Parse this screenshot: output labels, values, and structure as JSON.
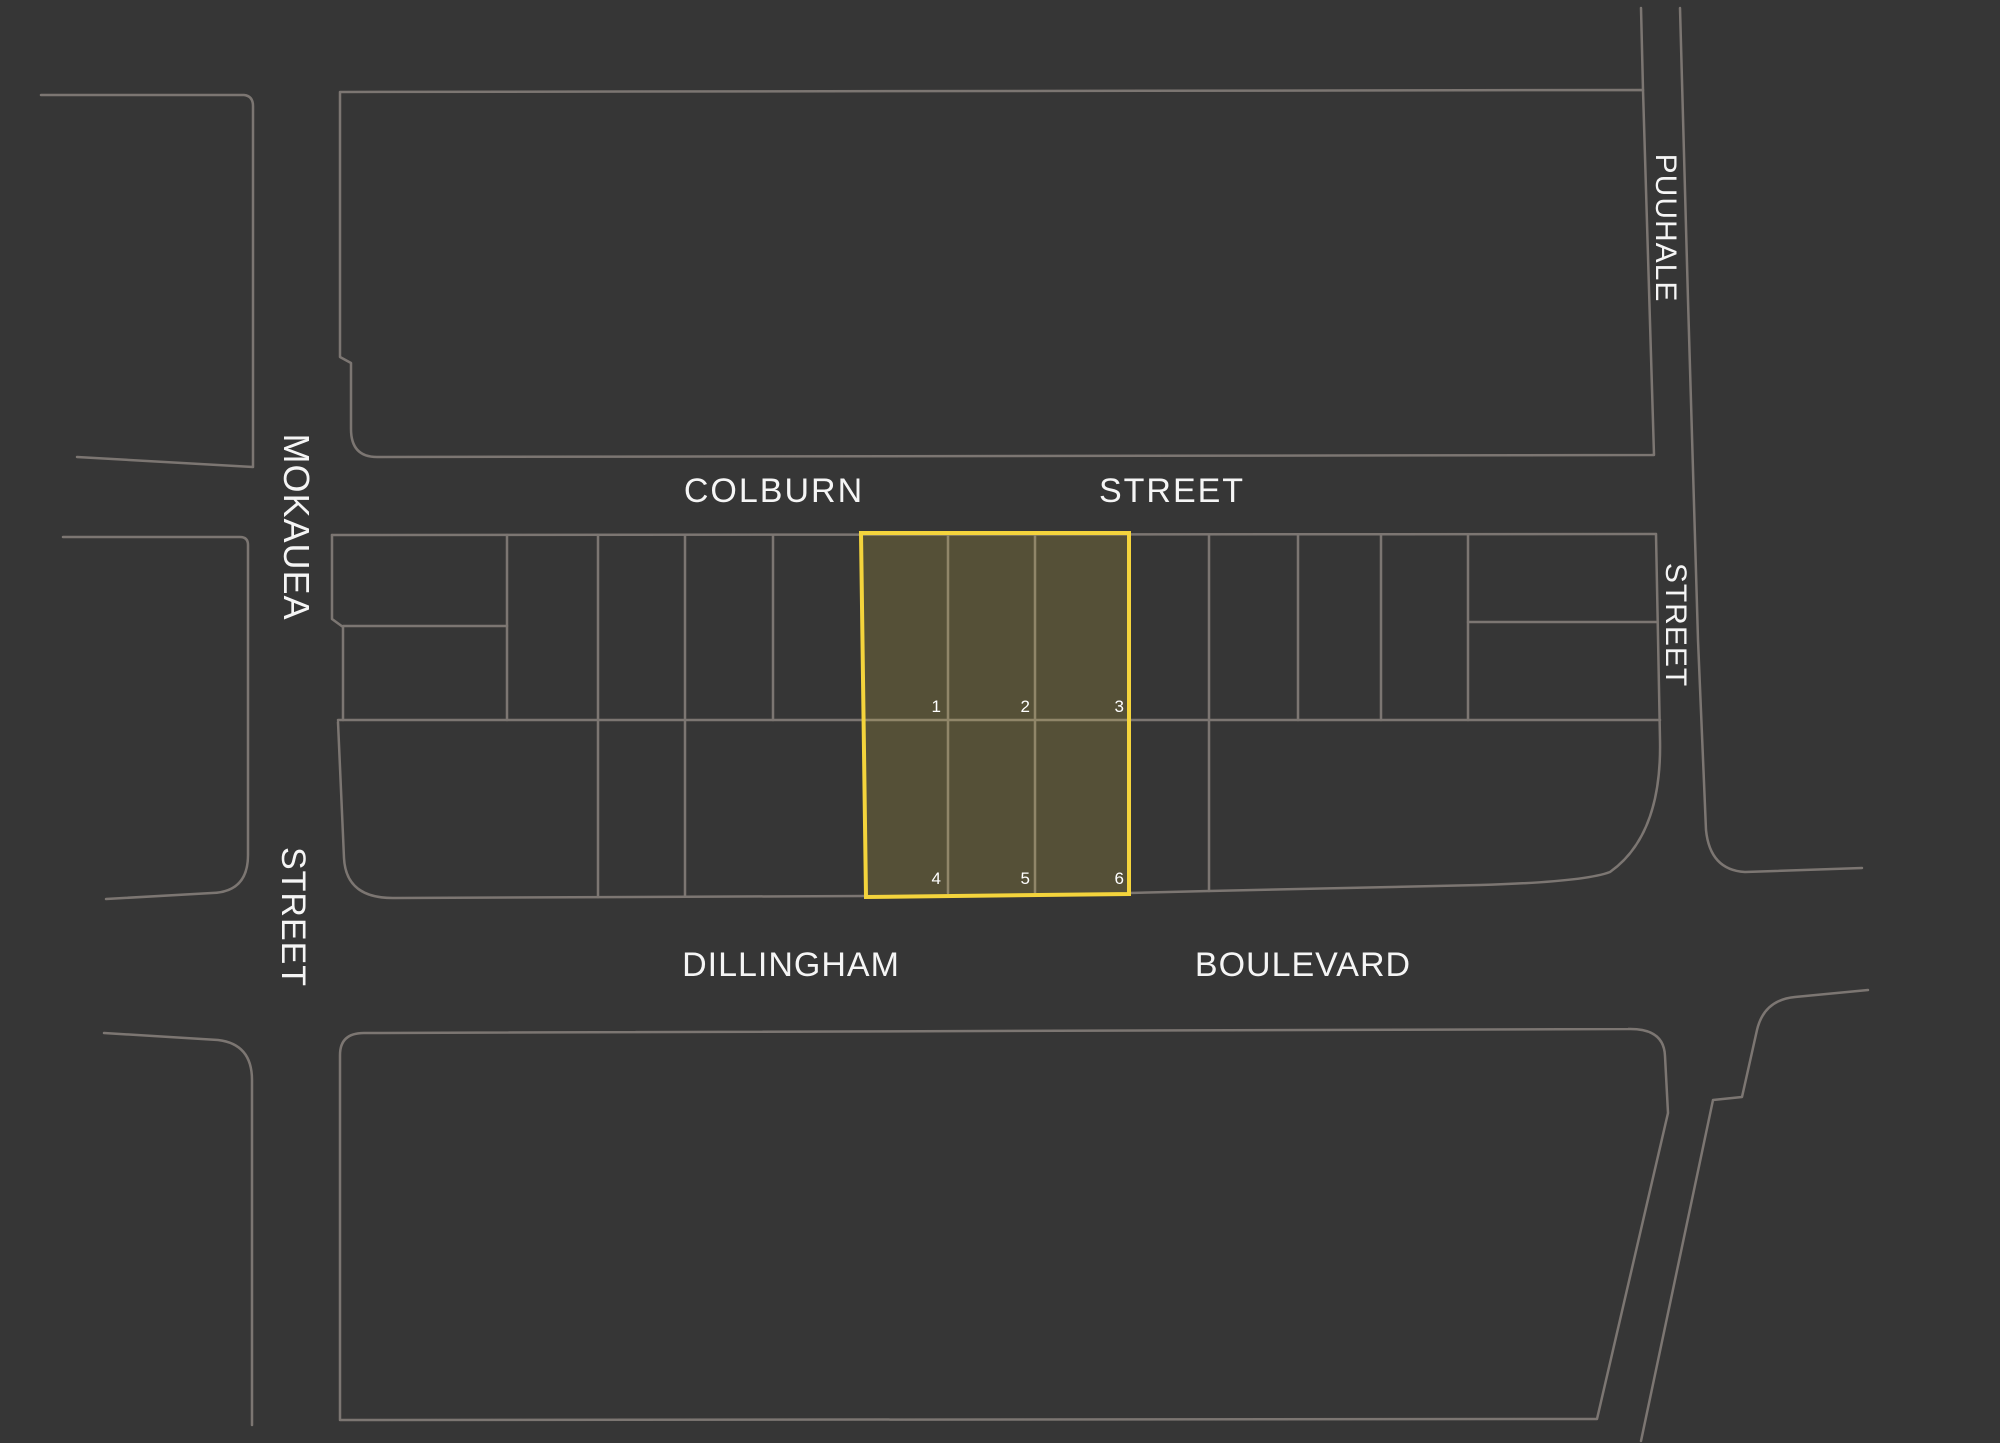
{
  "map": {
    "background_color": "#363636",
    "line_color": "#7c7672",
    "label_color": "#f5f5f5",
    "highlight": {
      "border_color": "#F4D43C",
      "fill_color": "rgba(245,211,63,0.17)",
      "lot_numbers": [
        "1",
        "2",
        "3",
        "4",
        "5",
        "6"
      ]
    },
    "streets": {
      "colburn": {
        "name": "COLBURN",
        "type": "STREET"
      },
      "dillingham": {
        "name": "DILLINGHAM",
        "type": "BOULEVARD"
      },
      "mokauea": {
        "name": "MOKAUEA",
        "type": "STREET"
      },
      "puuhale": {
        "name": "PUUHALE",
        "type": "STREET"
      }
    }
  }
}
